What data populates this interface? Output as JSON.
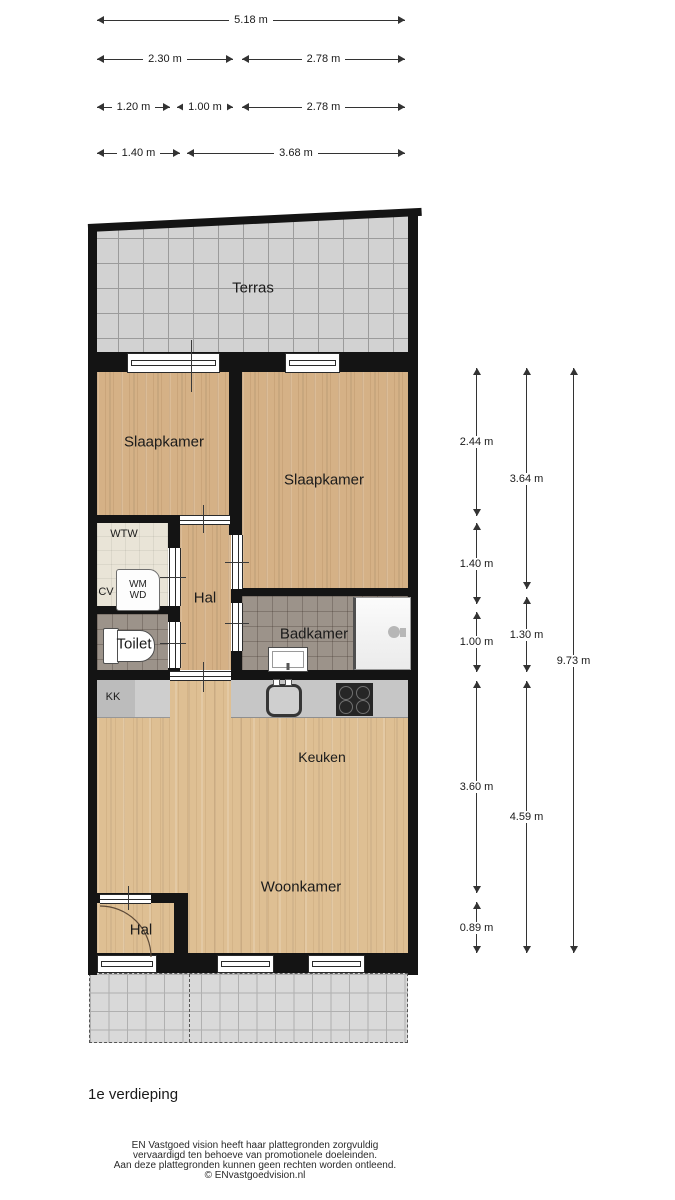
{
  "page": {
    "floor_title": "1e verdieping"
  },
  "floorplan": {
    "rooms": {
      "terras": "Terras",
      "slaapkamer_links": "Slaapkamer",
      "slaapkamer_rechts": "Slaapkamer",
      "hal_boven": "Hal",
      "hal_beneden": "Hal",
      "badkamer": "Badkamer",
      "toilet": "Toilet",
      "keuken": "Keuken",
      "woonkamer": "Woonkamer",
      "wtw": "WTW",
      "cv": "CV",
      "kk": "KK",
      "wm": "WM",
      "wd": "WD"
    },
    "dims_top": [
      "5.18 m",
      "2.30 m",
      "2.78 m",
      "1.20 m",
      "1.00 m",
      "2.78 m",
      "1.40 m",
      "3.68 m"
    ],
    "dims_right": [
      "2.44 m",
      "1.40 m",
      "1.00 m",
      "3.60 m",
      "0.89 m",
      "3.64 m",
      "1.30 m",
      "4.59 m",
      "9.73 m"
    ],
    "colors": {
      "wall": "#141414",
      "wood_floor": "#d5b186",
      "wood_floor_light": "#debf93",
      "terrace_tile": "#d2d2d2",
      "bathroom_tile": "#9c938a",
      "utility_floor": "#e9e4d7",
      "counter": "#c6c6c6"
    }
  },
  "footer": {
    "disclaimer_lines": [
      "EN Vastgoed vision heeft haar plattegronden zorgvuldig",
      "vervaardigd ten behoeve van promotionele doeleinden.",
      "Aan deze plattegronden kunnen geen rechten worden ontleend.",
      "© ENvastgoedvision.nl"
    ]
  }
}
